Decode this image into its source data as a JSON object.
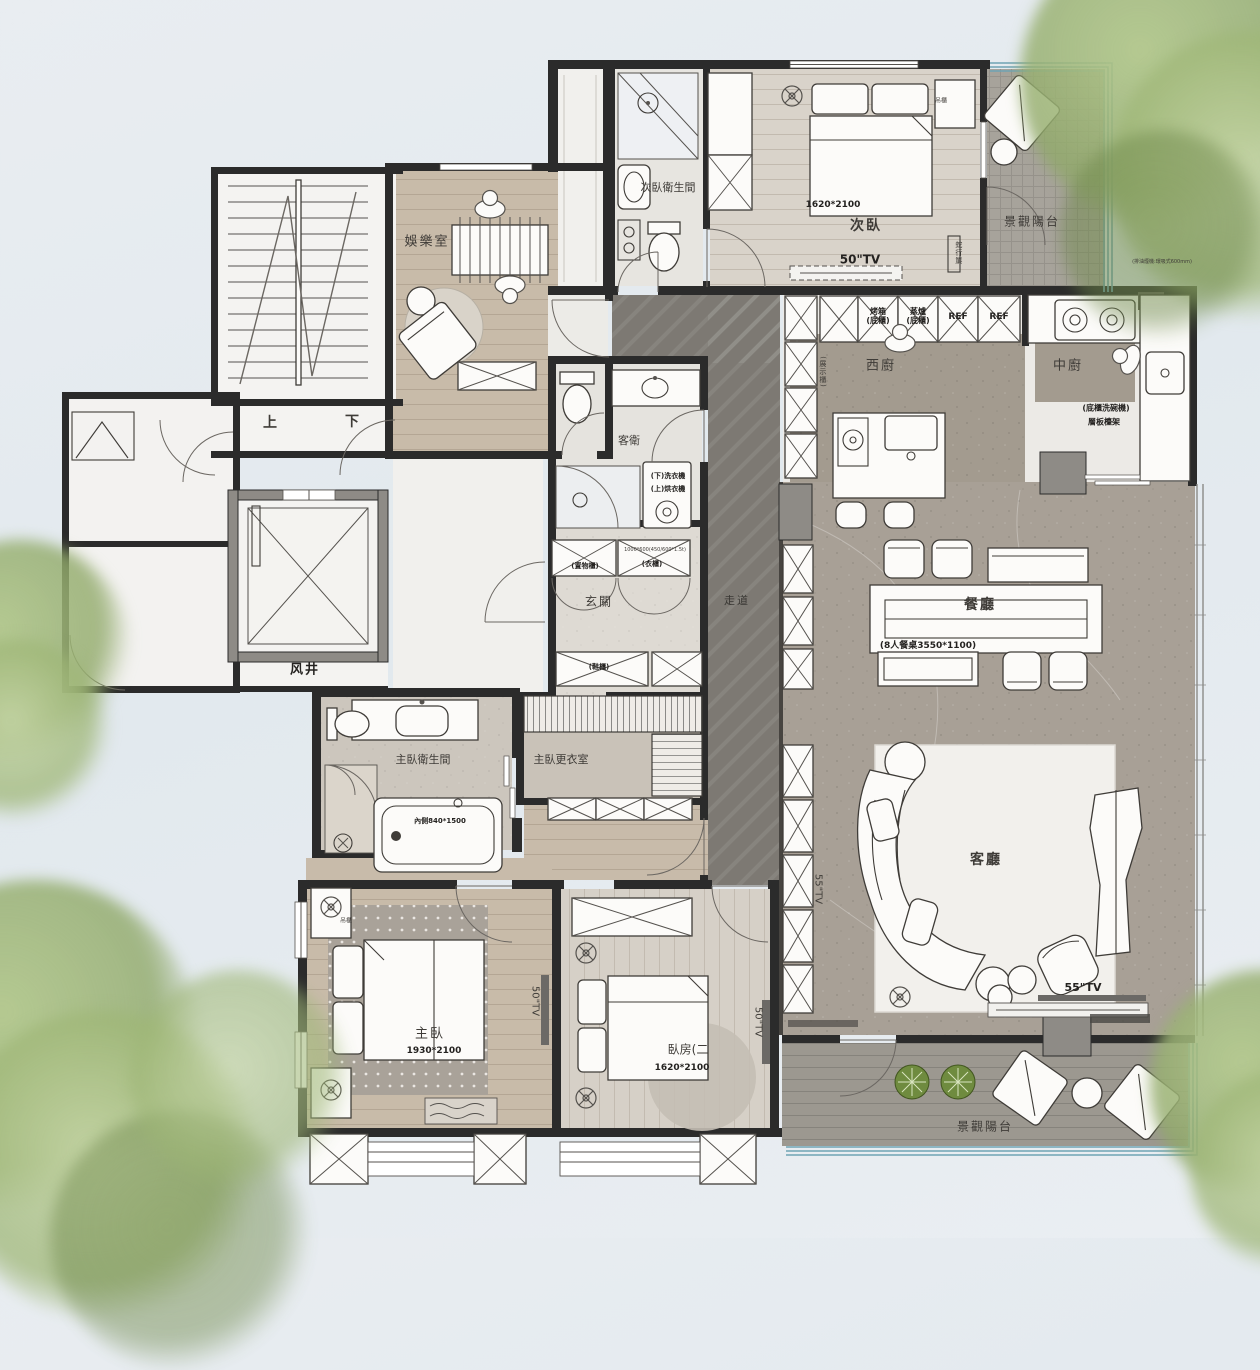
{
  "rooms": {
    "entertainment": {
      "label": "娛樂室"
    },
    "secondary_bathroom": {
      "label": "次臥衛生間"
    },
    "secondary_bedroom": {
      "label": "次臥",
      "bed_size": "1620*2100",
      "tv": "50\"TV",
      "hanging_cabinet": "吊櫃",
      "curtain_track": "蛇行簾"
    },
    "balcony_top": {
      "label": "景觀陽台"
    },
    "west_kitchen": {
      "label": "西廚",
      "oven": "烤箱\n(底櫃)",
      "steamer": "蒸爐\n(底櫃)",
      "fridge_1": "REF",
      "fridge_2": "REF",
      "display_cabinet": "(展示櫃)"
    },
    "chinese_kitchen": {
      "label": "中廚",
      "dishwasher_note": "(底櫃洗碗機)",
      "shelf_note": "層板檯架",
      "hood_note": "(排油煙機:環吸式600mm)"
    },
    "dining_room": {
      "label": "餐廳",
      "table_note": "(8人餐桌3550*1100)"
    },
    "living_room": {
      "label": "客廳",
      "tv": "55\"TV",
      "tv_wall": "55\"TV"
    },
    "corridor": {
      "label": "走道"
    },
    "guest_bathroom": {
      "label": "客衛",
      "washer": "(下)洗衣機",
      "dryer": "(上)烘衣機"
    },
    "entry": {
      "label": "玄關",
      "storage_cabinet": "(置物櫃)",
      "wardrobe": "(衣櫃)",
      "wardrobe_dim": "1000*600(450/600*1.5t)",
      "shoe_cabinet": "(鞋櫃)"
    },
    "master_bathroom": {
      "label": "主臥衛生間",
      "tub_dim": "內側840*1500"
    },
    "master_closet": {
      "label": "主臥更衣室"
    },
    "master_bedroom": {
      "label": "主臥",
      "bed_size": "1930*2100",
      "tv": "50\"TV",
      "hanging_cabinet": "吊櫃"
    },
    "bedroom_two": {
      "label": "臥房(二",
      "bed_size": "1620*2100",
      "tv": "50\"TV"
    },
    "balcony_bottom": {
      "label": "景觀陽台"
    },
    "core": {
      "air_shaft": "风井",
      "stair_up": "上",
      "stair_down": "下"
    }
  },
  "colors": {
    "wood": "#c8bba9",
    "stone": "#a8a096",
    "corridor": "#7d7973",
    "glass": "#6fa3b4",
    "tree": "#8fa868"
  }
}
